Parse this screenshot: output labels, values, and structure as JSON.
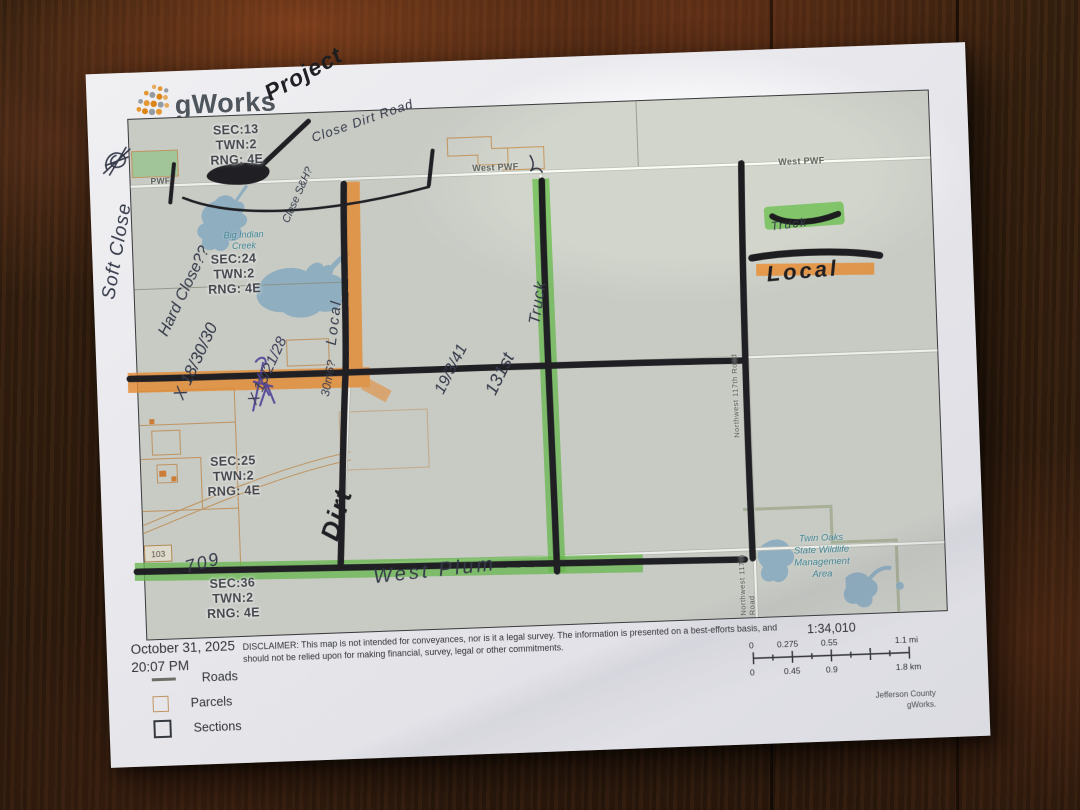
{
  "logo": {
    "text": "gWorks"
  },
  "map": {
    "section_labels": [
      {
        "line1": "SEC:13",
        "line2": "TWN:2",
        "line3": "RNG: 4E"
      },
      {
        "line1": "SEC:24",
        "line2": "TWN:2",
        "line3": "RNG: 4E"
      },
      {
        "line1": "SEC:25",
        "line2": "TWN:2",
        "line3": "RNG: 4E"
      },
      {
        "line1": "SEC:36",
        "line2": "TWN:2",
        "line3": "RNG: 4E"
      }
    ],
    "road_labels": {
      "pwf": "PWF",
      "west_pwf_1": "West PWF",
      "west_pwf_2": "West PWF",
      "nw_117th_1": "Northwest 117th Road",
      "nw_117th_2": "Northwest 117th Road"
    },
    "water_labels": {
      "big_indian_1": "Big Indian",
      "big_indian_2": "Creek"
    },
    "area_labels": {
      "twin_oaks_1": "Twin Oaks",
      "twin_oaks_2": "State Wildlife",
      "twin_oaks_3": "Management",
      "twin_oaks_4": "Area"
    },
    "highway_shield": "103"
  },
  "annotations": {
    "project": "Project",
    "close_dirt_road": "Close Dirt Road",
    "close_sh": "Close S&H?",
    "soft_close": "Soft Close",
    "hard_close": "Hard Close??",
    "x_18_30_30": "X 18/30/30",
    "x_13_21_28": "X 13/21/28",
    "m306": "30m6?",
    "local_road": "Local",
    "n19_3_41": "19/3/41",
    "n131st": "131st",
    "truck_road": "Truck",
    "dirt": "Dirt",
    "n709": "709",
    "west_plum": "West Plum",
    "legend_truck": "Truck",
    "legend_local": "Local"
  },
  "footer": {
    "date": "October 31, 2025",
    "time": "20:07 PM",
    "disclaimer": "DISCLAIMER: This map is not intended for conveyances, nor is it a legal survey. The information is presented on a best-efforts basis, and should not be relied upon for making financial, survey, legal or other commitments.",
    "legend": [
      {
        "label": "Roads"
      },
      {
        "label": "Parcels"
      },
      {
        "label": "Sections"
      }
    ],
    "scale_ratio": "1:34,010",
    "scale_mi": {
      "t0": "0",
      "t1": "0.275",
      "t2": "0.55",
      "t3": "1.1 mi"
    },
    "scale_km": {
      "t0": "0",
      "t1": "0.45",
      "t2": "0.9",
      "t3": "1.8 km"
    },
    "attribution_1": "Jefferson County",
    "attribution_2": "gWorks."
  },
  "colors": {
    "highlighter_orange": "#ef8f2e",
    "highlighter_green": "#6cbf4e",
    "marker_black": "#1d1d20",
    "pen_ink": "#333847",
    "purple_ink": "#4a3f9b",
    "map_background": "#d2d5cc",
    "parcel_line": "#c89a62",
    "water": "#8fb3c7",
    "logo_orange": "#f09d2f"
  }
}
